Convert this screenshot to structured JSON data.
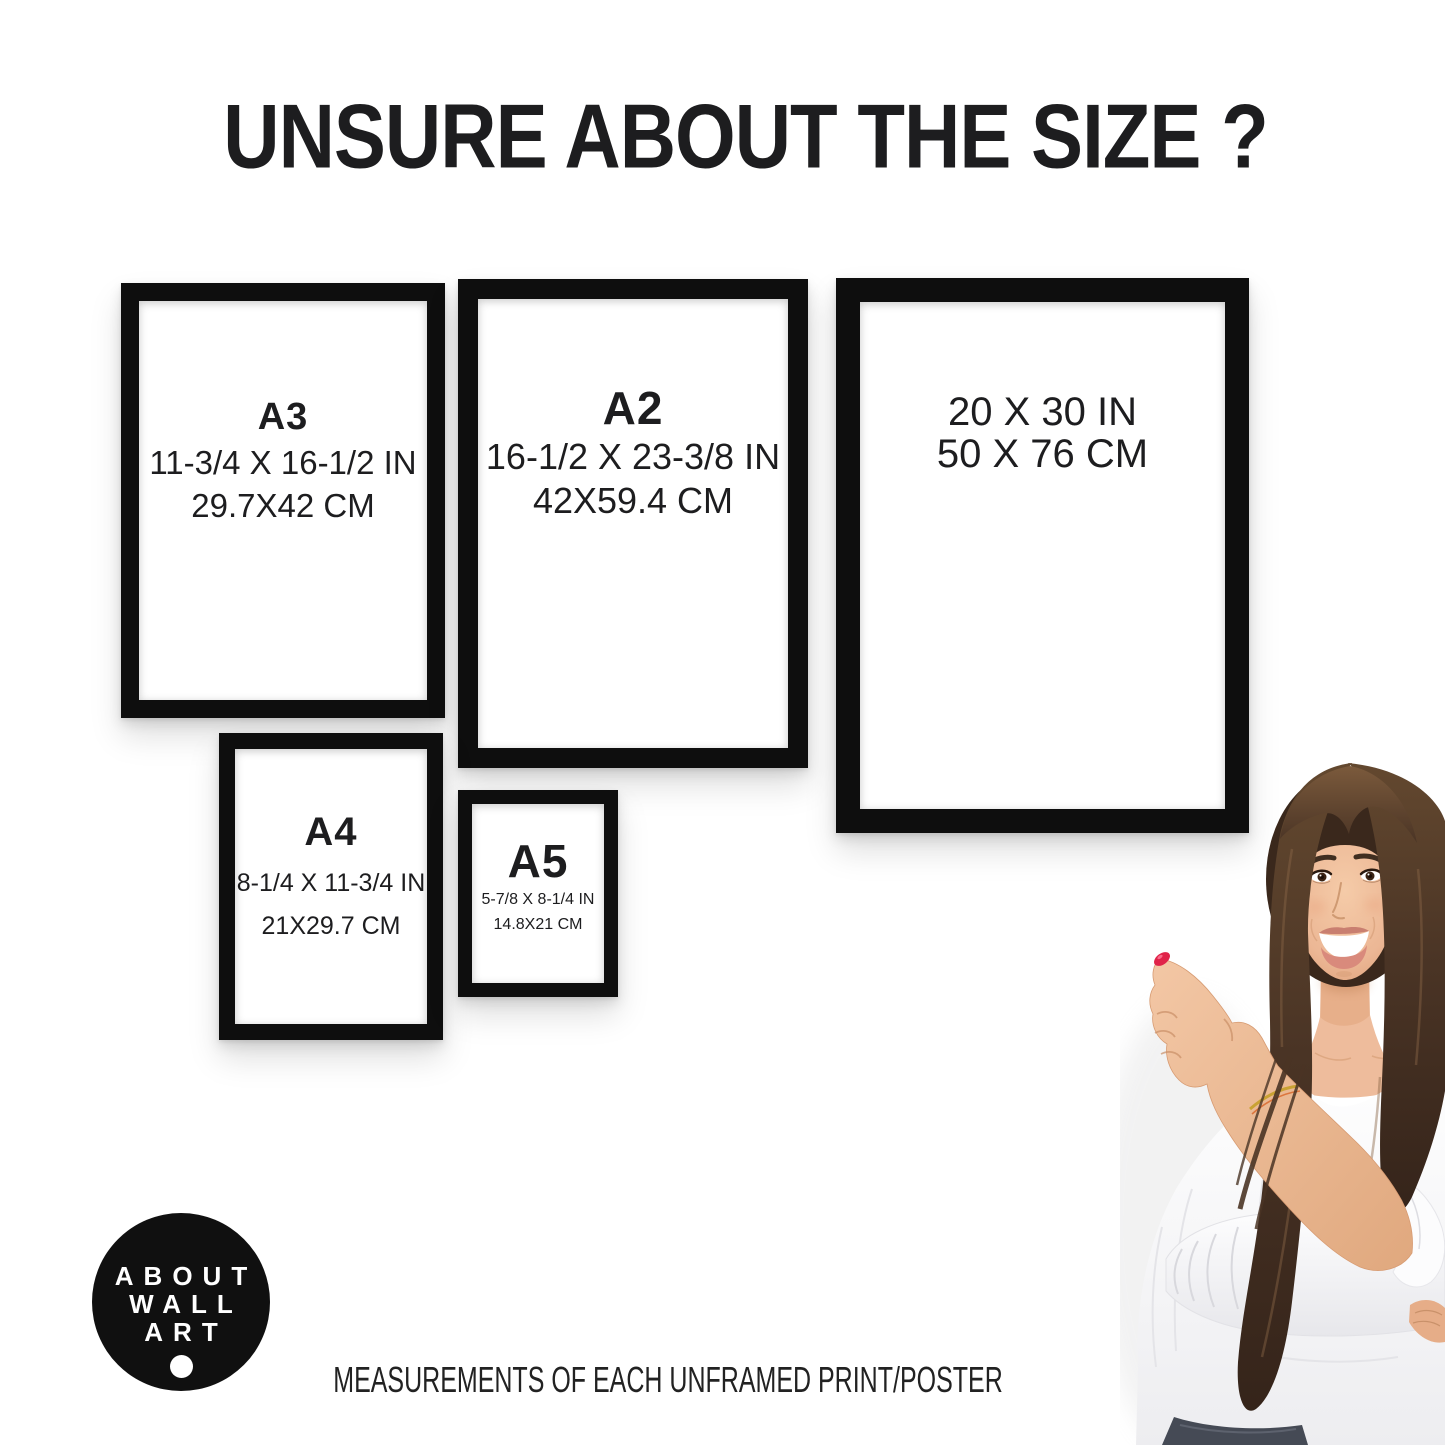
{
  "header": {
    "title": "UNSURE ABOUT THE SIZE ?"
  },
  "frames": [
    {
      "name": "a3",
      "label": "A3",
      "inches": "11-3/4 X 16-1/2 IN",
      "cm": "29.7X42 CM"
    },
    {
      "name": "a2",
      "label": "A2",
      "inches": "16-1/2 X 23-3/8 IN",
      "cm": "42X59.4 CM"
    },
    {
      "name": "20x30",
      "label": "",
      "inches": "20 X 30 IN",
      "cm": "50 X 76 CM"
    },
    {
      "name": "a4",
      "label": "A4",
      "inches": "8-1/4 X 11-3/4 IN",
      "cm": "21X29.7 CM"
    },
    {
      "name": "a5",
      "label": "A5",
      "inches": "5-7/8 X 8-1/4 IN",
      "cm": "14.8X21 CM"
    }
  ],
  "logo": {
    "line1": "ABOUT",
    "line2": "WALL",
    "line3": "ART"
  },
  "footer": {
    "caption": "MEASUREMENTS OF EACH UNFRAMED PRINT/POSTER"
  },
  "colors": {
    "frame": "#0e0e0e",
    "text": "#1d1d1f",
    "logo_bg": "#101010",
    "nail": "#e02349",
    "hair": "#4a3425",
    "hair_dark": "#3a281c",
    "skin": "#eebc9c",
    "blouse": "#fdfdfe",
    "jeans": "#454a55"
  }
}
